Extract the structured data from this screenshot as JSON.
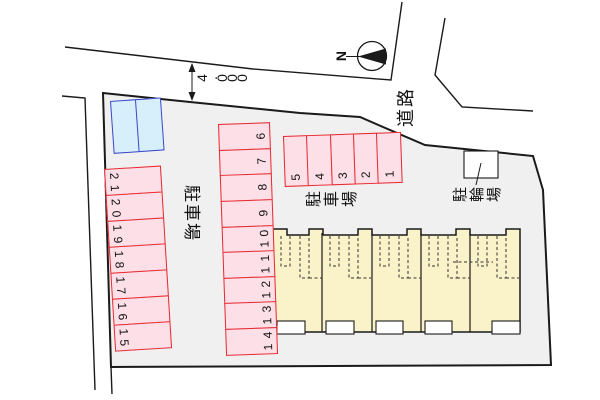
{
  "plan": {
    "north_label": "N",
    "dimension_label": "4.000",
    "road_label": "道路",
    "parking_label_left": "駐車場",
    "parking_label_top": "駐車場",
    "bicycle_label": "駐輪場",
    "left_numbers": [
      "21",
      "20",
      "19",
      "18",
      "17",
      "16",
      "15"
    ],
    "middle_numbers": [
      "6",
      "7",
      "8",
      "9",
      "10",
      "11",
      "12",
      "13",
      "14"
    ],
    "top_numbers": [
      "5",
      "4",
      "3",
      "2",
      "1"
    ],
    "building_units": 5
  },
  "colors": {
    "site_fill": "#f0f0f0",
    "line": "#1a1a1a",
    "stall_fill": "#fcdfe7",
    "stall_border": "#e8282f",
    "blue_stall_fill": "#d7effb",
    "blue_stall_border": "#3a46c8",
    "building_fill": "#faf2c8",
    "white": "#ffffff"
  }
}
